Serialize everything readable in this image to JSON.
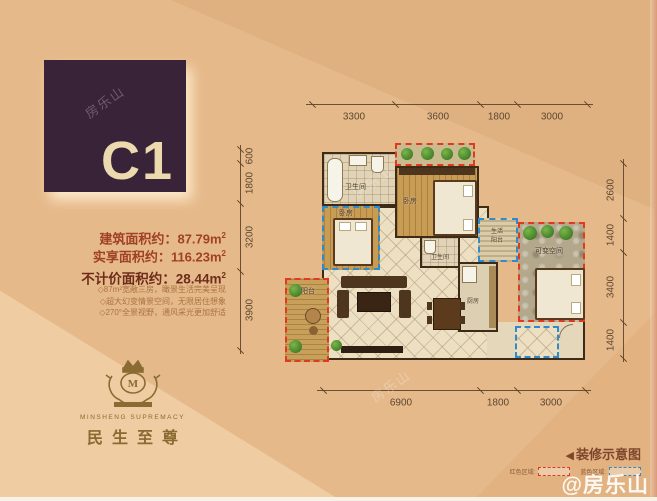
{
  "unit_label": "C1",
  "area_unit": "m",
  "area_sup": "2",
  "areas": [
    {
      "label": "建筑面积约：",
      "value": "87.79"
    },
    {
      "label": "实享面积约：",
      "value": "116.23"
    },
    {
      "label": "不计价面积约：",
      "value": "28.44"
    }
  ],
  "features": [
    "◇87m²宽敞三房，瞰景生活完美呈现",
    "◇超大幻变情景空间，无限居住想象",
    "◇270°全景视野，通风采光更加舒适"
  ],
  "brand": {
    "en": "MINSHENG SUPREMACY",
    "cn": "民生至尊"
  },
  "plan": {
    "dims_top": [
      "3300",
      "3600",
      "1800",
      "3000"
    ],
    "dims_left": [
      "600",
      "1800",
      "3200",
      "3900"
    ],
    "dims_right": [
      "2600",
      "1400",
      "3400",
      "1400"
    ],
    "dims_bottom": [
      "6900",
      "1800",
      "3000"
    ],
    "rooms": {
      "bath1": "卫生间",
      "bed_master": "卧房",
      "bed2": "卧房",
      "balcony": "阳台",
      "bath2": "卫生间",
      "kitchen": "厨房",
      "life_balcony_line1": "生活",
      "life_balcony_line2": "阳台",
      "variable": "可变空间"
    }
  },
  "legend": {
    "icon": "◀",
    "title": "装修示意图",
    "items": [
      {
        "label": "红色区域:"
      },
      {
        "label": "蓝色区域:"
      }
    ]
  },
  "watermark": {
    "corner": "@房乐山",
    "faint": "房乐山"
  },
  "colors": {
    "background": "#e6b98a",
    "badge": "#392339",
    "badge_text": "#ecd9ae",
    "area_text": "#a04026",
    "gold": "#8a6c33",
    "dash_red": "#df3a20",
    "dash_blue": "#2f8bc9",
    "wall": "#3d2b17"
  }
}
